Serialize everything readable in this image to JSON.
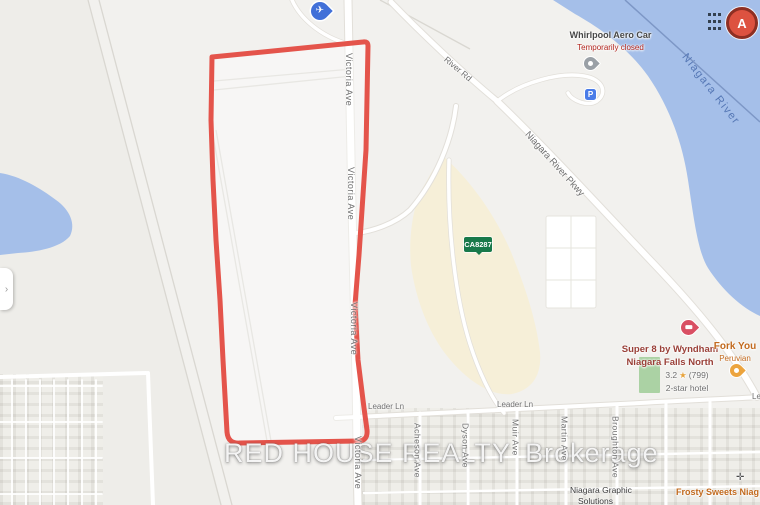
{
  "colors": {
    "land": "#f2f1ee",
    "shade": "#eeede9",
    "res": "#efeee9",
    "water": "#a5bfe9",
    "water_border": "#7d97c6",
    "water_label": "#5577b5",
    "commercial": "#f6efd8",
    "park": "#abd2a4",
    "road": "#ffffff",
    "casing": "#e2dfd9",
    "rail": "#d9d7d1",
    "outline": "#e4544b",
    "label_gray": "#6f6f6f",
    "poi_dark": "#474747",
    "closed_red": "#b3261e",
    "hotel_label": "#9a4038",
    "rating_gray": "#6e6e6e",
    "star": "#e7a33c",
    "orange_label": "#c26a1e",
    "dark_label": "#3b3b3b",
    "shield_green": "#18794a",
    "marker_fill": "#dd5240",
    "marker_border": "#8e2f23",
    "hotel_pin": "#d94f63",
    "fork_pin": "#eca43e",
    "parking_blue": "#4a7ce8",
    "plane_blue": "#4170d8",
    "pin_gray": "#9aa0a6",
    "watermark": "rgba(255,255,255,0.92)"
  },
  "watermark": {
    "main": "RED HOUSE REALTY",
    "suffix": "Brokerage"
  },
  "streets": {
    "victoria": "Victoria Ave",
    "leader": "Leader Ln",
    "leader_partial": "Le",
    "river_rd": "River Rd",
    "pkwy": "Niagara River Pkwy",
    "acheson": "Acheson Ave",
    "dyson": "Dyson Ave",
    "muir": "Muir Ave",
    "martin": "Martin Ave",
    "broughton": "Broughton Ave"
  },
  "water": {
    "name": "Niagara River"
  },
  "pois": {
    "aero_car": {
      "name": "Whirlpool Aero Car",
      "status": "Temporarily closed"
    },
    "hotel": {
      "line1": "Super 8 by Wyndham",
      "line2": "Niagara Falls North",
      "rating": "3.2",
      "reviews": "(799)",
      "category": "2-star hotel"
    },
    "fork_you": {
      "name": "Fork You",
      "category": "Peruvian"
    },
    "graphic": {
      "line1": "Niagara Graphic",
      "line2": "Solutions"
    },
    "frosty": {
      "name": "Frosty Sweets Niag…"
    },
    "shield": {
      "label": "CA8287"
    },
    "marker_a": {
      "label": "A"
    },
    "parking": {
      "label": "P"
    }
  },
  "icons": {
    "plane": "✈",
    "star": "★",
    "chevron": "›",
    "crosshair": "✛"
  }
}
